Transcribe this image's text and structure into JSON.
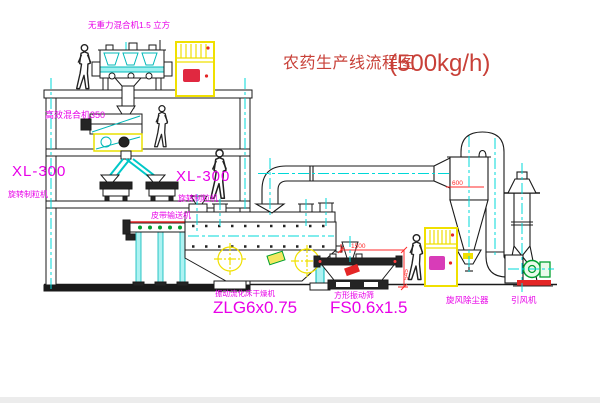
{
  "title": {
    "name": "农药生产线流程图",
    "capacity": "(500kg/h)"
  },
  "equipment_labels": {
    "roof_mixer": "无重力混合机1.5 立方",
    "floor_mixer": "高效混合机350",
    "left_granulator_model": "XL-300",
    "left_granulator_name": "旋转制粒机",
    "center_granulator_model": "XL-300",
    "center_granulator_name": "旋转制粒机",
    "belt_conveyor": "皮带输送机",
    "fluid_bed_dryer_name": "振动流化床干燥机",
    "fluid_bed_dryer_model": "ZLG6x0.75",
    "square_sieve_name": "方形振动筛",
    "square_sieve_model": "FS0.6x1.5",
    "cyclone_name": "旋风除尘器",
    "induced_draft_fan_name": "引风机"
  },
  "dimensions": {
    "sieve_length": "1500",
    "sieve_height": "545",
    "cyclone_diameter": "600"
  },
  "colors": {
    "label_magenta": "#e800e8",
    "title_red": "#c84038",
    "dimension_red": "#ff2a2a",
    "line_black": "#1a1a1a",
    "centerline_cyan": "#00d8d8",
    "cabinet_yellow": "#f0e000",
    "fan_green": "#00a030"
  }
}
